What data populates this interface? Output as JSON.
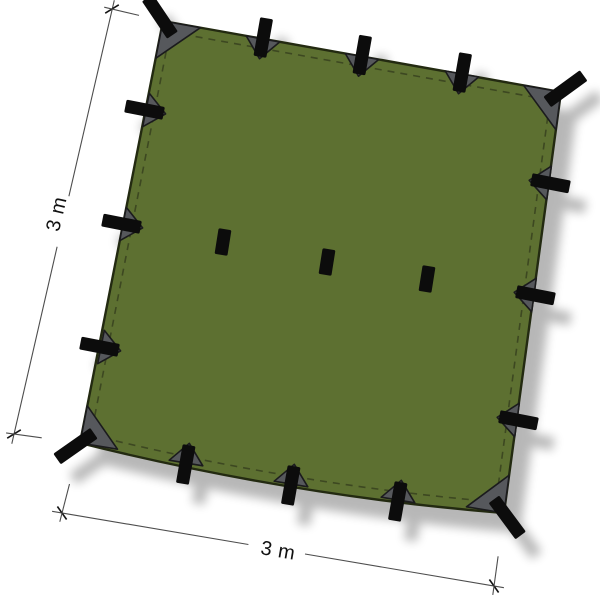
{
  "diagram": {
    "product": "square tarp",
    "width_label": "3 m",
    "height_label": "3 m",
    "attachment_loops": {
      "corner": 4,
      "edge": 12,
      "center": 3,
      "total": 19
    },
    "reinforcement_patches": 16
  },
  "colors": {
    "background": "#ffffff",
    "tarp_green": "#5d7031",
    "tarp_edge": "#232a11",
    "stitch": "#3a4420",
    "patch_grey": "#56585c",
    "patch_edge": "#1b1b1d",
    "tab_black": "#0c0c0c",
    "dim_line": "#4d4d4d",
    "dim_tick": "#141414",
    "dim_text": "#111111",
    "shadow": "#000000"
  }
}
